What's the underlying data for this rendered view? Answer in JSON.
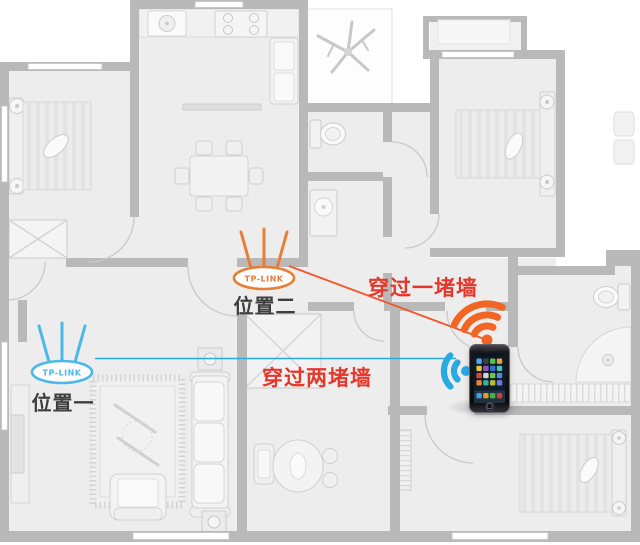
{
  "diagram": {
    "annotations": {
      "through_one_wall": "穿过一堵墙",
      "through_two_walls": "穿过两堵墙"
    },
    "routers": [
      {
        "id": "position-1",
        "brand": "TP-LINK",
        "label": "位置一",
        "outline_color": "#4AB8E8",
        "line_color": "#29ABE2"
      },
      {
        "id": "position-2",
        "brand": "TP-LINK",
        "label": "位置二",
        "outline_color": "#E87E35",
        "line_color": "#F1582C"
      }
    ],
    "device": {
      "type": "smartphone"
    },
    "icons": [
      {
        "name": "wifi-signal-orange-icon",
        "color": "#F26522"
      },
      {
        "name": "wifi-signal-blue-icon",
        "color": "#29ABE2"
      }
    ],
    "colors": {
      "annotation_text": "#E5372B",
      "wall": "#B9B9B9",
      "floor": "#EDEDED",
      "label_text": "#3E3E3E",
      "background": "#FFFFFF"
    }
  }
}
